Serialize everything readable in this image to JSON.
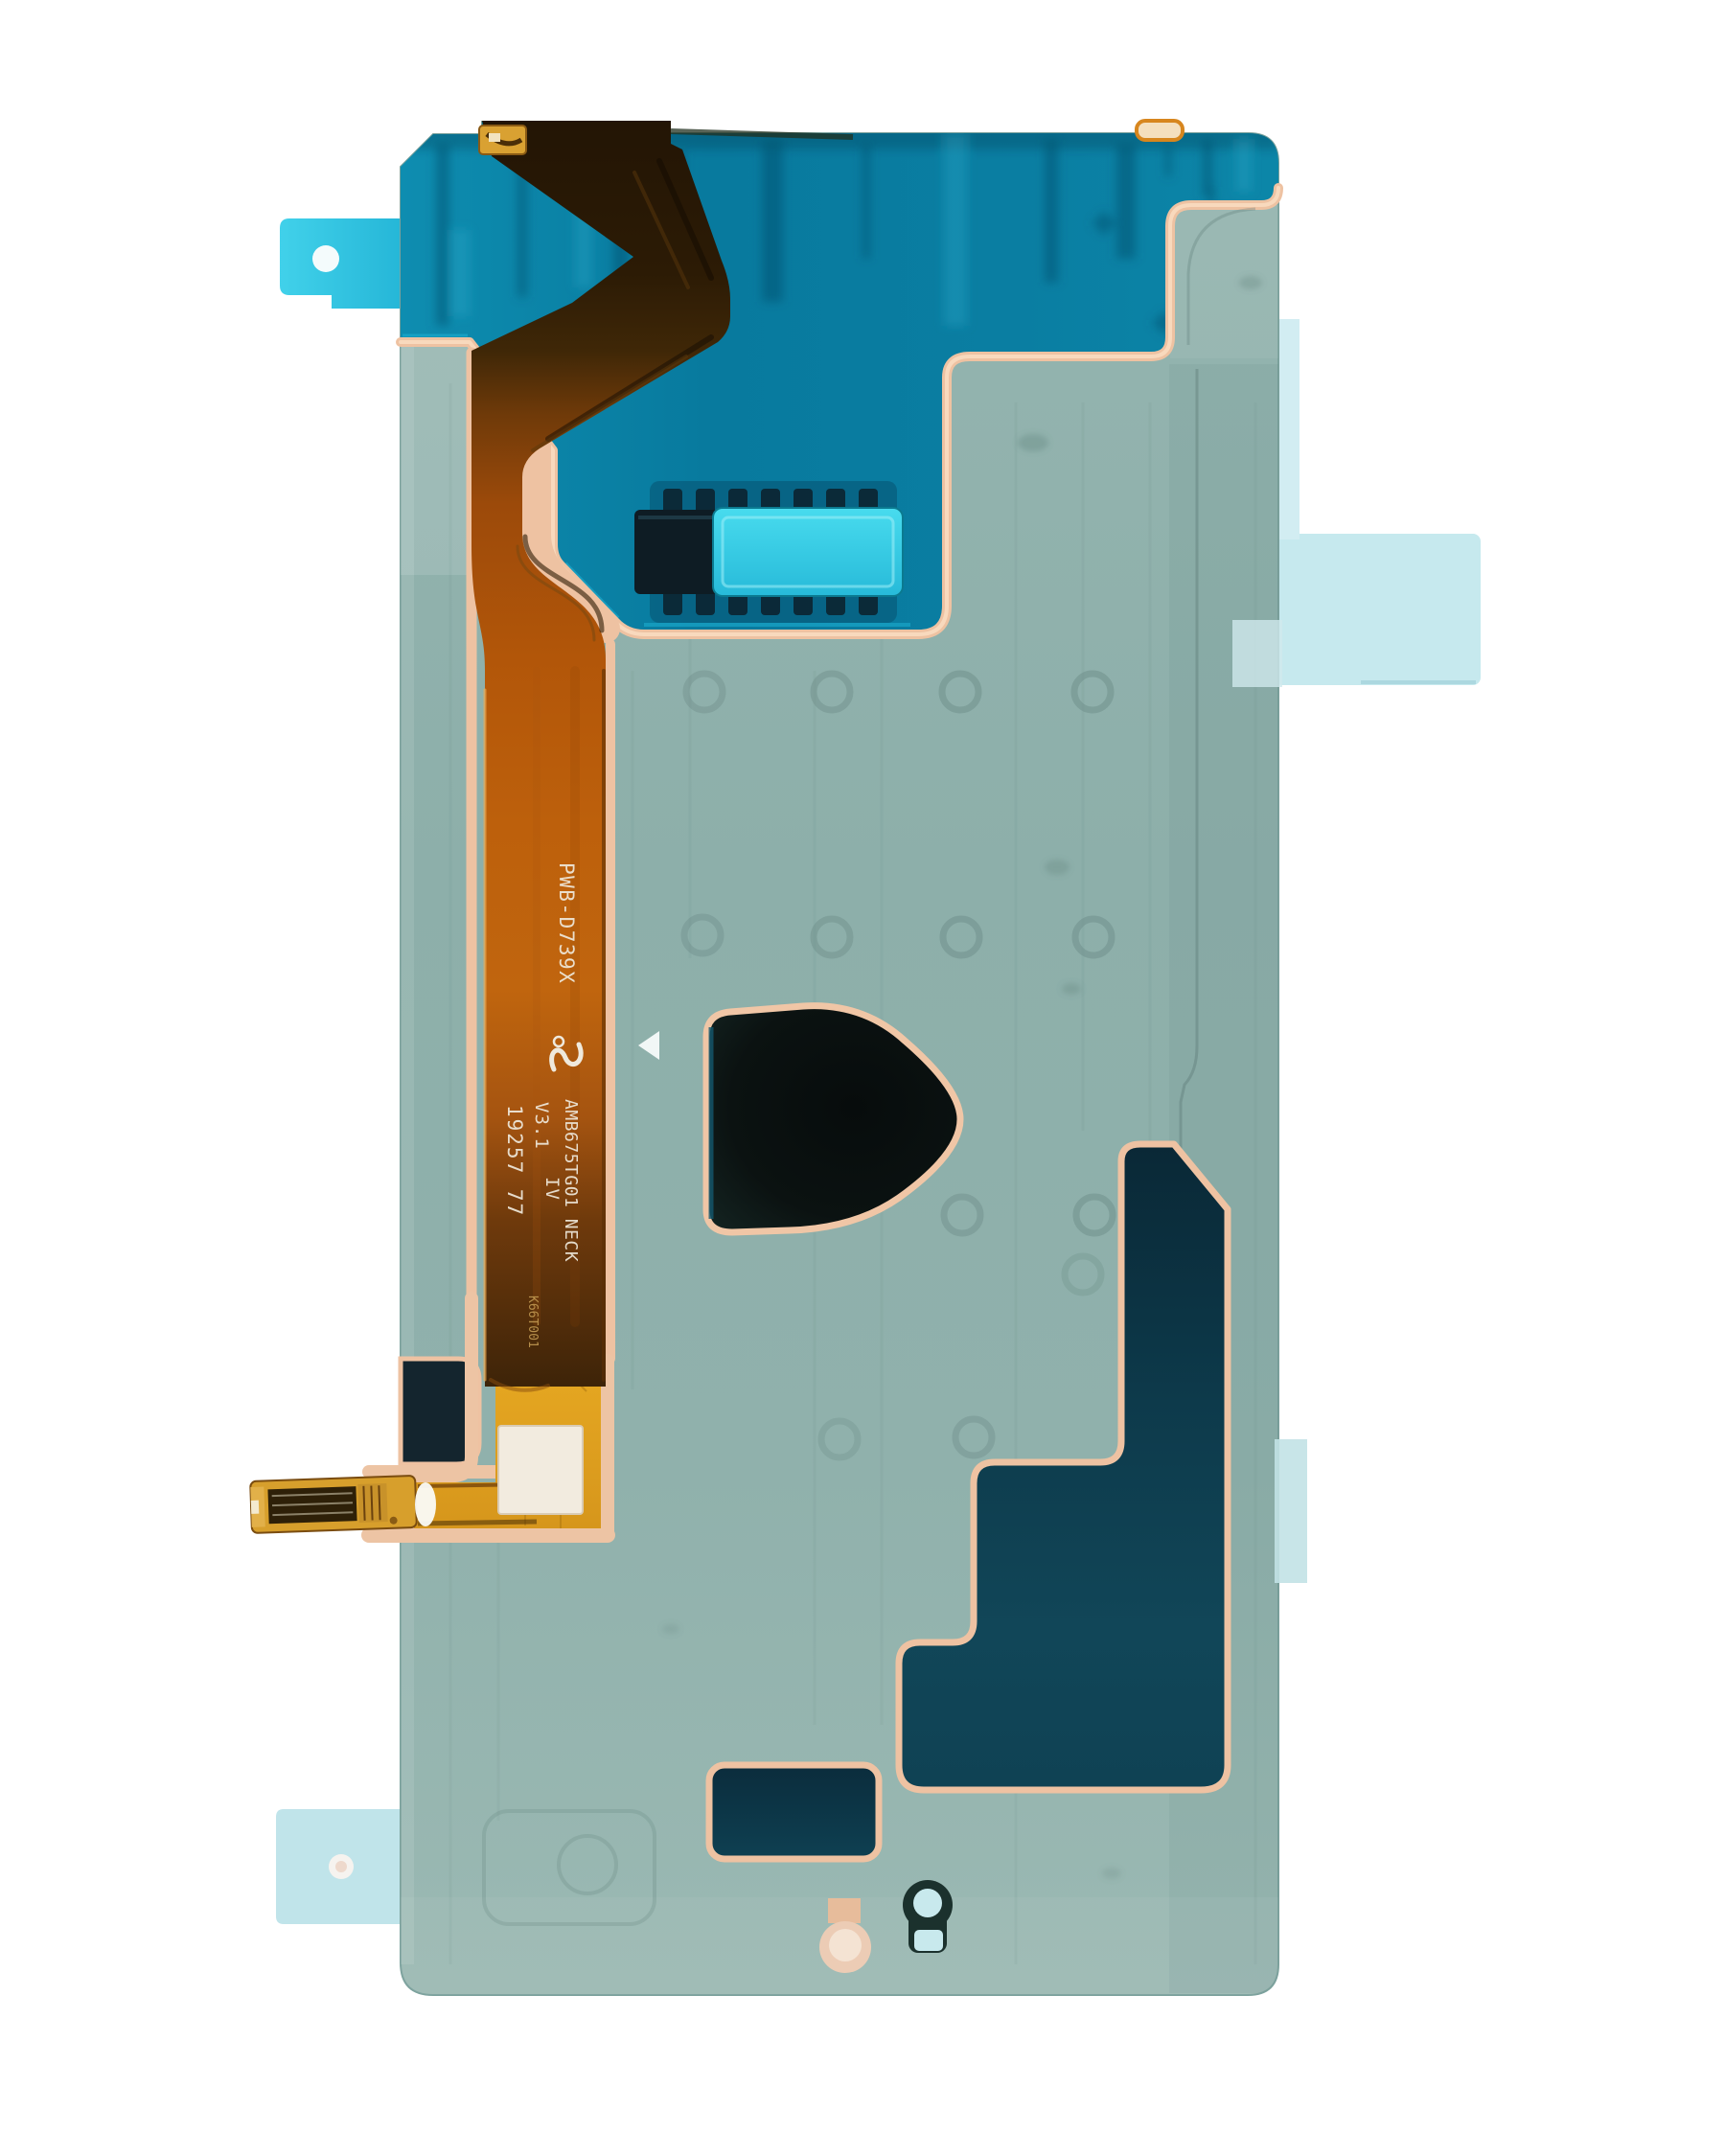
{
  "photo": {
    "subject": "OLED display sensor adhesive film with flex cable, rear view product photo",
    "background_color": "#ffffff"
  },
  "markings": {
    "model": "PWB-D739X",
    "part_number": "AMB675TG01 NECK",
    "version": "V3.1",
    "grade": "IV",
    "batch": "19257 77",
    "serial": "K66T001",
    "certification": "cULus mark"
  },
  "palette": {
    "film_base": "#8fb0ab",
    "teal_zone": "#0a7ea2",
    "adhesive_outline": "#eec2a2",
    "flex_copper": "#b85c0c",
    "flex_gold": "#e2a321",
    "cyan_pull_tab": "#2fc6e6",
    "light_pull_tab": "#c6e9ee",
    "dark_cutout": "#0c1312",
    "dark_step_cutout": "#0d3a4b",
    "label_sticker": "#f2ebdf"
  }
}
